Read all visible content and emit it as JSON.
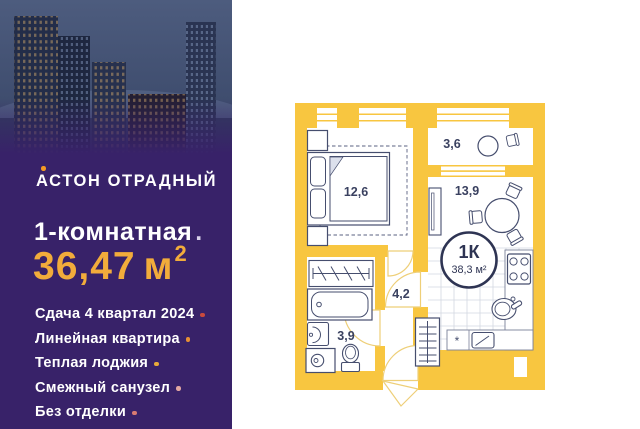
{
  "brand": {
    "name": "АСТОН ОТРАДНЫЙ",
    "accent_color": "#f59a23"
  },
  "listing": {
    "rooms_label": "1-комнатная",
    "rooms_label_period": ".",
    "area_value": "36,47",
    "area_unit": "м",
    "area_sup": "2",
    "area_color": "#f2ac3b",
    "features": [
      {
        "text": "Сдача 4 квартал 2024",
        "dot_color": "#c94a3d"
      },
      {
        "text": "Линейная квартира",
        "dot_color": "#e78f35"
      },
      {
        "text": "Теплая лоджия",
        "dot_color": "#e9aa3a"
      },
      {
        "text": "Смежный санузел",
        "dot_color": "#e3a8a2"
      },
      {
        "text": "Без отделки",
        "dot_color": "#d97c72"
      }
    ]
  },
  "floorplan": {
    "badge": {
      "type_label": "1К",
      "total_area": "38,3 м²"
    },
    "labels": {
      "bedroom": "12,6",
      "loggia": "3,6",
      "kitchen_living": "13,9",
      "hallway": "4,2",
      "bathroom": "3,9"
    },
    "fridge_mark": "*",
    "colors": {
      "wall": "#f8c640",
      "line": "#464e6e",
      "badge": "#2e3453"
    }
  }
}
